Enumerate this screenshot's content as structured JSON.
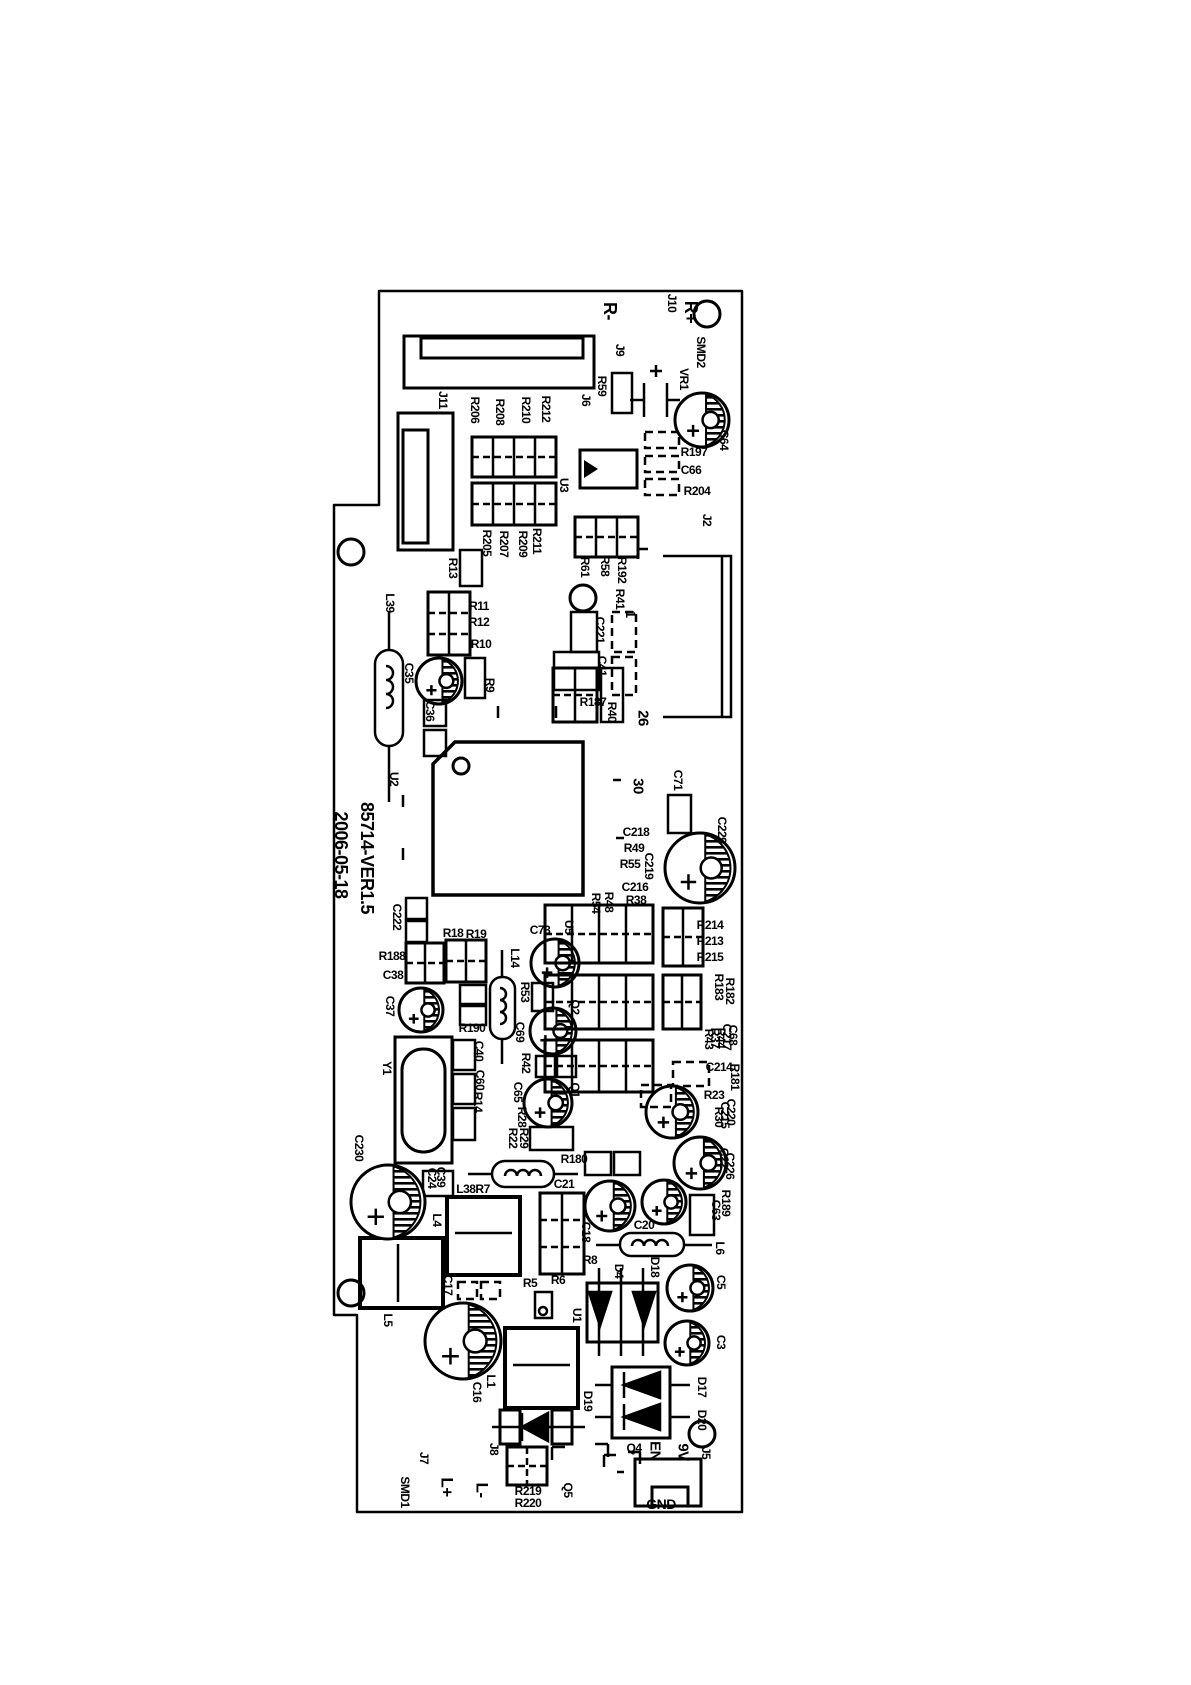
{
  "board": {
    "version": "85714-VER1.5",
    "date": "2006-05-18",
    "colors": {
      "silkscreen": "#000000",
      "background": "#ffffff"
    },
    "labels": [
      {
        "t": "R-",
        "x": 610,
        "y": 311,
        "o": "v",
        "s": 18
      },
      {
        "t": "J10",
        "x": 672,
        "y": 303,
        "o": "v",
        "s": 12
      },
      {
        "t": "R+",
        "x": 691,
        "y": 312,
        "o": "v",
        "s": 18
      },
      {
        "t": "J9",
        "x": 620,
        "y": 350,
        "o": "v",
        "s": 12
      },
      {
        "t": "SMD2",
        "x": 701,
        "y": 352,
        "o": "v",
        "s": 12
      },
      {
        "t": "VR1",
        "x": 684,
        "y": 379,
        "o": "v",
        "s": 12
      },
      {
        "t": "C64",
        "x": 724,
        "y": 440,
        "o": "v",
        "s": 12
      },
      {
        "t": "R59",
        "x": 602,
        "y": 386,
        "o": "v",
        "s": 12
      },
      {
        "t": "J6",
        "x": 586,
        "y": 400,
        "o": "v",
        "s": 12
      },
      {
        "t": "J11",
        "x": 443,
        "y": 400,
        "o": "v",
        "s": 12
      },
      {
        "t": "R206",
        "x": 475,
        "y": 410,
        "o": "v",
        "s": 12
      },
      {
        "t": "R208",
        "x": 500,
        "y": 412,
        "o": "v",
        "s": 12
      },
      {
        "t": "R210",
        "x": 526,
        "y": 410,
        "o": "v",
        "s": 12
      },
      {
        "t": "R212",
        "x": 546,
        "y": 409,
        "o": "v",
        "s": 12
      },
      {
        "t": "U3",
        "x": 564,
        "y": 485,
        "o": "v",
        "s": 12
      },
      {
        "t": "R205",
        "x": 487,
        "y": 543,
        "o": "v",
        "s": 12
      },
      {
        "t": "R207",
        "x": 504,
        "y": 544,
        "o": "v",
        "s": 12
      },
      {
        "t": "R209",
        "x": 523,
        "y": 544,
        "o": "v",
        "s": 12
      },
      {
        "t": "R211",
        "x": 537,
        "y": 541,
        "o": "v",
        "s": 12
      },
      {
        "t": "R197",
        "x": 694,
        "y": 452,
        "o": "h",
        "s": 12
      },
      {
        "t": "C66",
        "x": 691,
        "y": 470,
        "o": "h",
        "s": 12
      },
      {
        "t": "R204",
        "x": 697,
        "y": 491,
        "o": "h",
        "s": 12
      },
      {
        "t": "J2",
        "x": 707,
        "y": 520,
        "o": "v",
        "s": 12
      },
      {
        "t": "R61",
        "x": 585,
        "y": 567,
        "o": "v",
        "s": 12
      },
      {
        "t": "R58",
        "x": 605,
        "y": 566,
        "o": "v",
        "s": 12
      },
      {
        "t": "R192",
        "x": 622,
        "y": 570,
        "o": "v",
        "s": 12
      },
      {
        "t": "R41",
        "x": 620,
        "y": 599,
        "o": "v",
        "s": 12
      },
      {
        "t": "1",
        "x": 631,
        "y": 614,
        "o": "v",
        "s": 14
      },
      {
        "t": "C221",
        "x": 600,
        "y": 630,
        "o": "v",
        "s": 12
      },
      {
        "t": "C41",
        "x": 602,
        "y": 666,
        "o": "v",
        "s": 12
      },
      {
        "t": "R13",
        "x": 453,
        "y": 568,
        "o": "v",
        "s": 12
      },
      {
        "t": "L39",
        "x": 390,
        "y": 603,
        "o": "v",
        "s": 12
      },
      {
        "t": "R11",
        "x": 479,
        "y": 606,
        "o": "h",
        "s": 12
      },
      {
        "t": "R12",
        "x": 479,
        "y": 622,
        "o": "h",
        "s": 12
      },
      {
        "t": "R10",
        "x": 481,
        "y": 644,
        "o": "h",
        "s": 12
      },
      {
        "t": "C35",
        "x": 409,
        "y": 673,
        "o": "v",
        "s": 12
      },
      {
        "t": "R9",
        "x": 490,
        "y": 685,
        "o": "v",
        "s": 12
      },
      {
        "t": "C36",
        "x": 430,
        "y": 711,
        "o": "v",
        "s": 12
      },
      {
        "t": "R187",
        "x": 593,
        "y": 702,
        "o": "h",
        "s": 12
      },
      {
        "t": "R40",
        "x": 612,
        "y": 712,
        "o": "v",
        "s": 12
      },
      {
        "t": "26",
        "x": 643,
        "y": 718,
        "o": "v",
        "s": 15
      },
      {
        "t": "U2",
        "x": 394,
        "y": 779,
        "o": "v",
        "s": 12
      },
      {
        "t": "30",
        "x": 638,
        "y": 786,
        "o": "v",
        "s": 15
      },
      {
        "t": "C71",
        "x": 678,
        "y": 780,
        "o": "v",
        "s": 12
      },
      {
        "t": "C229",
        "x": 722,
        "y": 830,
        "o": "v",
        "s": 12
      },
      {
        "t": "C218",
        "x": 636,
        "y": 832,
        "o": "h",
        "s": 12
      },
      {
        "t": "R49",
        "x": 634,
        "y": 848,
        "o": "h",
        "s": 12
      },
      {
        "t": "C219",
        "x": 649,
        "y": 866,
        "o": "v",
        "s": 12
      },
      {
        "t": "R55",
        "x": 630,
        "y": 864,
        "o": "h",
        "s": 12
      },
      {
        "t": "C216",
        "x": 635,
        "y": 887,
        "o": "h",
        "s": 12
      },
      {
        "t": "R38",
        "x": 636,
        "y": 900,
        "o": "h",
        "s": 12
      },
      {
        "t": "R48",
        "x": 609,
        "y": 902,
        "o": "v",
        "s": 12
      },
      {
        "t": "R54",
        "x": 596,
        "y": 903,
        "o": "v",
        "s": 12
      },
      {
        "t": "R214",
        "x": 710,
        "y": 925,
        "o": "h",
        "s": 12
      },
      {
        "t": "R213",
        "x": 710,
        "y": 941,
        "o": "h",
        "s": 12
      },
      {
        "t": "R215",
        "x": 710,
        "y": 957,
        "o": "h",
        "s": 12
      },
      {
        "t": "R183",
        "x": 719,
        "y": 987,
        "o": "v",
        "s": 12
      },
      {
        "t": "R182",
        "x": 730,
        "y": 991,
        "o": "v",
        "s": 12
      },
      {
        "t": "C222",
        "x": 397,
        "y": 917,
        "o": "v",
        "s": 12
      },
      {
        "t": "R18",
        "x": 453,
        "y": 933,
        "o": "h",
        "s": 12
      },
      {
        "t": "R19",
        "x": 476,
        "y": 934,
        "o": "h",
        "s": 12
      },
      {
        "t": "R188",
        "x": 392,
        "y": 956,
        "o": "h",
        "s": 12
      },
      {
        "t": "C38",
        "x": 393,
        "y": 975,
        "o": "h",
        "s": 12
      },
      {
        "t": "C37",
        "x": 390,
        "y": 1006,
        "o": "v",
        "s": 12
      },
      {
        "t": "C73",
        "x": 540,
        "y": 930,
        "o": "h",
        "s": 12
      },
      {
        "t": "U5",
        "x": 569,
        "y": 927,
        "o": "v",
        "s": 12
      },
      {
        "t": "L14",
        "x": 515,
        "y": 958,
        "o": "v",
        "s": 12
      },
      {
        "t": "R53",
        "x": 525,
        "y": 992,
        "o": "v",
        "s": 12
      },
      {
        "t": "R190",
        "x": 472,
        "y": 1028,
        "o": "h",
        "s": 12
      },
      {
        "t": "C69",
        "x": 520,
        "y": 1032,
        "o": "v",
        "s": 12
      },
      {
        "t": "R42",
        "x": 526,
        "y": 1063,
        "o": "v",
        "s": 12
      },
      {
        "t": "Y1",
        "x": 387,
        "y": 1068,
        "o": "v",
        "s": 12
      },
      {
        "t": "C40",
        "x": 479,
        "y": 1051,
        "o": "v",
        "s": 12
      },
      {
        "t": "C60",
        "x": 480,
        "y": 1080,
        "o": "v",
        "s": 12
      },
      {
        "t": "R14",
        "x": 478,
        "y": 1102,
        "o": "v",
        "s": 12
      },
      {
        "t": "C65",
        "x": 518,
        "y": 1092,
        "o": "v",
        "s": 12
      },
      {
        "t": "R28",
        "x": 522,
        "y": 1117,
        "o": "v",
        "s": 12
      },
      {
        "t": "R22",
        "x": 513,
        "y": 1138,
        "o": "v",
        "s": 12
      },
      {
        "t": "R29",
        "x": 524,
        "y": 1138,
        "o": "v",
        "s": 12
      },
      {
        "t": "Q2",
        "x": 575,
        "y": 1007,
        "o": "v",
        "s": 12
      },
      {
        "t": "Q1",
        "x": 575,
        "y": 1090,
        "o": "v",
        "s": 12
      },
      {
        "t": "C68",
        "x": 733,
        "y": 1035,
        "o": "v",
        "s": 12
      },
      {
        "t": "C217",
        "x": 727,
        "y": 1037,
        "o": "v",
        "s": 12
      },
      {
        "t": "R44",
        "x": 721,
        "y": 1038,
        "o": "v",
        "s": 12
      },
      {
        "t": "R37",
        "x": 715,
        "y": 1038,
        "o": "v",
        "s": 12
      },
      {
        "t": "R43",
        "x": 709,
        "y": 1039,
        "o": "v",
        "s": 12
      },
      {
        "t": "C214",
        "x": 719,
        "y": 1067,
        "o": "h",
        "s": 12
      },
      {
        "t": "R181",
        "x": 735,
        "y": 1077,
        "o": "v",
        "s": 12
      },
      {
        "t": "R23",
        "x": 714,
        "y": 1095,
        "o": "h",
        "s": 12
      },
      {
        "t": "C220",
        "x": 731,
        "y": 1112,
        "o": "v",
        "s": 12
      },
      {
        "t": "C215",
        "x": 725,
        "y": 1115,
        "o": "v",
        "s": 12
      },
      {
        "t": "R30",
        "x": 719,
        "y": 1117,
        "o": "v",
        "s": 12
      },
      {
        "t": "C22",
        "x": 724,
        "y": 1158,
        "o": "v",
        "s": 12
      },
      {
        "t": "C226",
        "x": 730,
        "y": 1166,
        "o": "v",
        "s": 12
      },
      {
        "t": "R189",
        "x": 726,
        "y": 1203,
        "o": "v",
        "s": 12
      },
      {
        "t": "C63",
        "x": 716,
        "y": 1210,
        "o": "v",
        "s": 12
      },
      {
        "t": "R180",
        "x": 574,
        "y": 1159,
        "o": "h",
        "s": 12
      },
      {
        "t": "C21",
        "x": 564,
        "y": 1184,
        "o": "h",
        "s": 12
      },
      {
        "t": "L38R7",
        "x": 473,
        "y": 1189,
        "o": "h",
        "s": 12
      },
      {
        "t": "C39",
        "x": 441,
        "y": 1177,
        "o": "v",
        "s": 12
      },
      {
        "t": "C24",
        "x": 432,
        "y": 1178,
        "o": "v",
        "s": 12
      },
      {
        "t": "C230",
        "x": 359,
        "y": 1148,
        "o": "v",
        "s": 12
      },
      {
        "t": "L4",
        "x": 437,
        "y": 1220,
        "o": "v",
        "s": 12
      },
      {
        "t": "C18",
        "x": 586,
        "y": 1232,
        "o": "v",
        "s": 12
      },
      {
        "t": "R8",
        "x": 590,
        "y": 1260,
        "o": "h",
        "s": 12
      },
      {
        "t": "C20",
        "x": 644,
        "y": 1225,
        "o": "h",
        "s": 12
      },
      {
        "t": "L6",
        "x": 720,
        "y": 1248,
        "o": "v",
        "s": 12
      },
      {
        "t": "C5",
        "x": 721,
        "y": 1282,
        "o": "v",
        "s": 12
      },
      {
        "t": "L5",
        "x": 388,
        "y": 1320,
        "o": "v",
        "s": 12
      },
      {
        "t": "C17",
        "x": 448,
        "y": 1285,
        "o": "v",
        "s": 12
      },
      {
        "t": "R5",
        "x": 530,
        "y": 1283,
        "o": "h",
        "s": 12
      },
      {
        "t": "R6",
        "x": 558,
        "y": 1280,
        "o": "h",
        "s": 12
      },
      {
        "t": "U1",
        "x": 577,
        "y": 1315,
        "o": "v",
        "s": 12
      },
      {
        "t": "D4",
        "x": 619,
        "y": 1271,
        "o": "v",
        "s": 12
      },
      {
        "t": "D18",
        "x": 655,
        "y": 1267,
        "o": "v",
        "s": 12
      },
      {
        "t": "C16",
        "x": 477,
        "y": 1392,
        "o": "v",
        "s": 12
      },
      {
        "t": "L1",
        "x": 491,
        "y": 1381,
        "o": "v",
        "s": 12
      },
      {
        "t": "C3",
        "x": 721,
        "y": 1342,
        "o": "v",
        "s": 12
      },
      {
        "t": "D19",
        "x": 588,
        "y": 1401,
        "o": "v",
        "s": 12
      },
      {
        "t": "D17",
        "x": 702,
        "y": 1387,
        "o": "v",
        "s": 12
      },
      {
        "t": "D20",
        "x": 702,
        "y": 1420,
        "o": "v",
        "s": 12
      },
      {
        "t": "J8",
        "x": 494,
        "y": 1449,
        "o": "v",
        "s": 12
      },
      {
        "t": "Q4",
        "x": 634,
        "y": 1448,
        "o": "h",
        "s": 12
      },
      {
        "t": "EN",
        "x": 655,
        "y": 1451,
        "o": "v",
        "s": 15
      },
      {
        "t": "9V",
        "x": 683,
        "y": 1452,
        "o": "v",
        "s": 15
      },
      {
        "t": "J5",
        "x": 706,
        "y": 1453,
        "o": "v",
        "s": 12
      },
      {
        "t": "Q5",
        "x": 568,
        "y": 1490,
        "o": "v",
        "s": 12
      },
      {
        "t": "R219",
        "x": 528,
        "y": 1491,
        "o": "h",
        "s": 12
      },
      {
        "t": "R220",
        "x": 528,
        "y": 1503,
        "o": "h",
        "s": 12
      },
      {
        "t": "J7",
        "x": 424,
        "y": 1458,
        "o": "v",
        "s": 12
      },
      {
        "t": "SMD1",
        "x": 405,
        "y": 1492,
        "o": "v",
        "s": 12
      },
      {
        "t": "L+",
        "x": 447,
        "y": 1487,
        "o": "v",
        "s": 17
      },
      {
        "t": "L-",
        "x": 482,
        "y": 1490,
        "o": "v",
        "s": 17
      },
      {
        "t": "GND",
        "x": 661,
        "y": 1504,
        "o": "h",
        "s": 14
      }
    ]
  }
}
